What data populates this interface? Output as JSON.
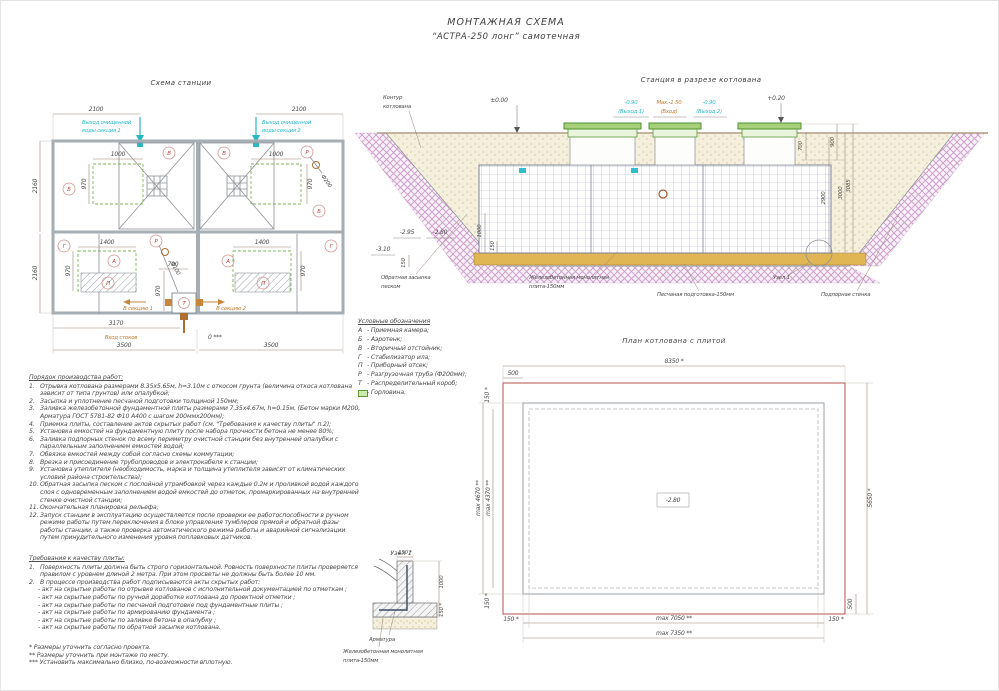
{
  "page": {
    "title_line1": "МОНТАЖНАЯ СХЕМА",
    "title_line2": "“АСТРА-250 лонг” самотечная"
  },
  "station_plan": {
    "title": "Схема станции",
    "dims": {
      "top1": "2100",
      "top2": "2100",
      "w1000a": "1000",
      "w1000b": "1000",
      "h970a": "970",
      "h970b": "970",
      "w1400a": "1400",
      "w1400b": "1400",
      "h970c": "970",
      "h970d": "970",
      "w700": "700",
      "h970e": "970",
      "inner": "3170",
      "b1": "3500",
      "b2": "3500",
      "side1": "2160",
      "side2": "2160",
      "zero": "0 ***"
    },
    "ann": {
      "out1a": "Выход очищенной",
      "out1b": "воды секция 1",
      "out2a": "Выход очищенной",
      "out2b": "воды секция 2",
      "inlet": "Вход стоков",
      "sec1": "В секцию 1",
      "sec2": "В секцию 2",
      "f200": "Ф200",
      "f100": "Ф100"
    },
    "letters": {
      "B1": "Б",
      "V1": "В",
      "V2": "В",
      "B2": "Б",
      "G1": "Г",
      "A1": "А",
      "P1": "П",
      "A2": "А",
      "P2": "П",
      "G2": "Г",
      "R1": "Р",
      "R2": "Р",
      "T": "Т"
    }
  },
  "section": {
    "title": "Станция в разрезе котлована",
    "contour1": "Контур",
    "contour2": "котлована",
    "levels": {
      "zero": "±0.00",
      "plus": "+0.20",
      "out1": "-0.90",
      "out1b": "(Выход 1)",
      "inlet": "Max.-1.50",
      "inletb": "(Вход)",
      "out2": "-0.90",
      "out2b": "(Выход 2)",
      "m295": "-2.95",
      "m280": "-2.80",
      "m310": "-3.10"
    },
    "dims": {
      "d700": "700",
      "d900": "900",
      "d3000": "3000",
      "d3085": "3085",
      "d2900": "2900",
      "d150a": "150",
      "d150b": "150",
      "d1000": "1000"
    },
    "labels": {
      "backfill1": "Обратная засыпка",
      "backfill2": "песком",
      "plate1": "Железобетонная монолитная",
      "plate2": "плита-150мм",
      "sand": "Песчаная подготовка-150мм",
      "wall": "Подпорная стенка",
      "node": "Узел 1"
    }
  },
  "legend": {
    "title": "Условные обозначения",
    "items": [
      {
        "key": "А",
        "desc": "-  Приемная камера;"
      },
      {
        "key": "Б",
        "desc": "-  Аэротенк;"
      },
      {
        "key": "В",
        "desc": "-  Вторичный отстойник;"
      },
      {
        "key": "Г",
        "desc": "-  Стабилизатор ила;"
      },
      {
        "key": "П",
        "desc": "-  Приборный отсек;"
      },
      {
        "key": "Р",
        "desc": "-  Разгрузочная труба (Ф200мм);"
      },
      {
        "key": "Т",
        "desc": "-  Распределительный короб;"
      },
      {
        "key": "",
        "desc": "-  Горловина."
      }
    ]
  },
  "pit_plan": {
    "title": "План котлована с плитой",
    "center": "-2.80",
    "dims": {
      "top": "8350 *",
      "top500": "500",
      "left150t": "150 *",
      "left4670": "max 4670 **",
      "left4370": "max 4370 **",
      "left150b": "150 *",
      "b150l": "150 *",
      "b7050": "max 7050 **",
      "b150r": "150 *",
      "b7350": "max 7350 **",
      "right5650": "5650 *",
      "right500": "500"
    }
  },
  "node_detail": {
    "title": "Узел 1",
    "dims": {
      "top": "150 *",
      "side": "1000",
      "bottom": "150 *"
    },
    "labels": {
      "rebar": "Арматура",
      "plate1": "Железобетонная монолитная",
      "plate2": "плита-150мм"
    }
  },
  "work_order": {
    "title": "Порядок производства работ:",
    "items": [
      {
        "num": "1.",
        "text": "Отрывка котлована размерами 8.35х5.65м, h=3.10м с откосом грунта (величина откоса котлована зависит от типа грунтов) или опалубкой;"
      },
      {
        "num": "2.",
        "text": "Засыпка и уплотнение песчаной подготовки толщиной 150мм;"
      },
      {
        "num": "3.",
        "text": "Заливка железобетонной фундаментной плиты размерами 7.35х4.67м, h=0.15м. (Бетон марки М200, Арматура ГОСТ 5781-82 Ф10 А400 с шагом 200ммх200мм);"
      },
      {
        "num": "4.",
        "text": "Приемка плиты, составление актов скрытых работ (см. \"Требования к качеству плиты\" п.2);"
      },
      {
        "num": "5.",
        "text": "Установка емкостей на фундаментную плиту после набора прочности бетона не менее 80%;"
      },
      {
        "num": "6.",
        "text": "Заливка подпорных стенок по всему периметру очистной станции без внутренней опалубки с параллельным заполнением емкостей водой;"
      },
      {
        "num": "7.",
        "text": "Обвязка емкостей между собой согласно схемы коммутации;"
      },
      {
        "num": "8.",
        "text": "Врезка и присоединение трубопроводов и электрокабеля к станции;"
      },
      {
        "num": "9.",
        "text": "Установка утеплителя (необходимость, марка и толщина утеплителя зависят от климатических условий района строительства);"
      },
      {
        "num": "10.",
        "text": "Обратная засыпка песком с послойной утрамбовкой через каждые 0.2м и проливкой водой каждого слоя с одновременным заполнением водой емкостей до отметок, промаркированных на внутренней стенке очистной станции;"
      },
      {
        "num": "11.",
        "text": "Окончательная планировка рельефа;"
      },
      {
        "num": "12.",
        "text": "Запуск станции в эксплуатацию осуществляется после проверки ее работоспособности в ручном режиме работы путем переключения в блоке управления тумблеров прямой и обратной фазы работы станции, а также проверка автоматического режима работы и аварийной сигнализации путем принудительного изменения уровня поплавковых датчиков."
      }
    ]
  },
  "quality": {
    "title": "Требования к качеству плиты:",
    "items": [
      {
        "num": "1.",
        "text": "Поверхность плиты должна быть строго горизонтальной. Ровность поверхности плиты проверяется правилом с уровнем длиной 2 метра. При этом просветы не должны быть более 10 мм."
      },
      {
        "num": "2.",
        "text": "В процессе производства работ подписываются акты скрытых работ:"
      }
    ],
    "acts": [
      "- акт на скрытые работы по отрывке котлованов с исполнительной документацией по отметкам ;",
      "- акт на скрытые работы по ручной доработке котлована до проектной отметки ;",
      "- акт на скрытые работы по песчаной подготовке под фундаментные плиты ;",
      "- акт на скрытые работы по армированию фундамента ;",
      "- акт на скрытые работы по заливке бетона в опалубку ;",
      "- акт на скрытые работы по обратной засыпке котлована."
    ]
  },
  "notes": [
    "* Размеры уточнить согласно проекта.",
    "** Размеры уточнить при монтаже по месту.",
    "*** Установить максимально близко, по-возможности вплотную."
  ]
}
